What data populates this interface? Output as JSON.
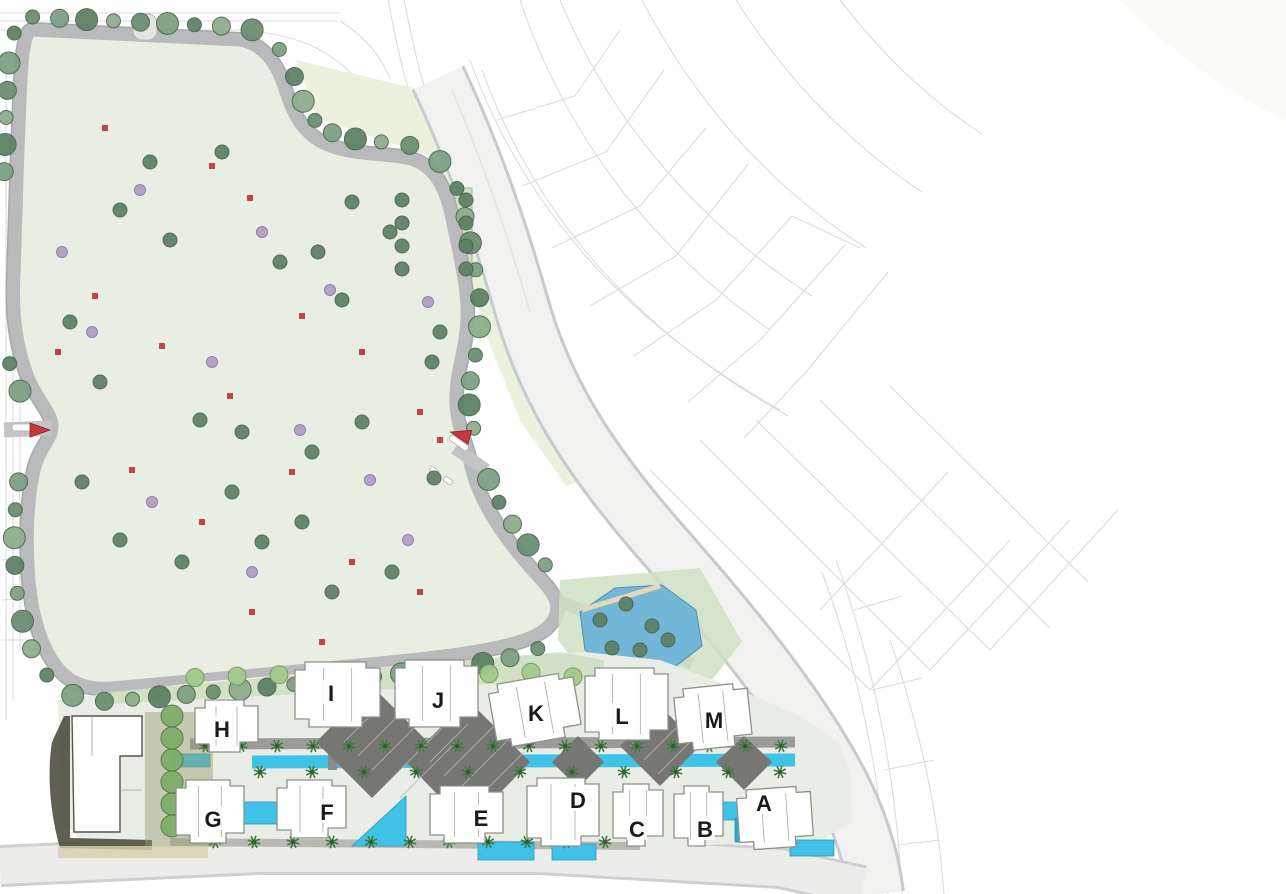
{
  "map": {
    "kind": "residential master plan site map",
    "buildings": [
      {
        "label": "H",
        "x": 222,
        "y": 729
      },
      {
        "label": "I",
        "x": 331,
        "y": 693
      },
      {
        "label": "J",
        "x": 438,
        "y": 700
      },
      {
        "label": "K",
        "x": 536,
        "y": 713
      },
      {
        "label": "L",
        "x": 622,
        "y": 716
      },
      {
        "label": "M",
        "x": 714,
        "y": 720
      },
      {
        "label": "G",
        "x": 213,
        "y": 819
      },
      {
        "label": "F",
        "x": 327,
        "y": 812
      },
      {
        "label": "E",
        "x": 481,
        "y": 818
      },
      {
        "label": "D",
        "x": 578,
        "y": 800
      },
      {
        "label": "C",
        "x": 637,
        "y": 829
      },
      {
        "label": "B",
        "x": 705,
        "y": 829
      },
      {
        "label": "A",
        "x": 764,
        "y": 803
      }
    ],
    "rows": {
      "upper_row_labels": [
        "H",
        "I",
        "J",
        "K",
        "L",
        "M"
      ],
      "lower_row_labels": [
        "G",
        "F",
        "E",
        "D",
        "C",
        "B",
        "A"
      ]
    },
    "entrance_markers": [
      {
        "name": "west-entrance-marker",
        "x": 30,
        "y": 423,
        "angle": 0
      },
      {
        "name": "main-entrance-marker",
        "x": 468,
        "y": 444,
        "angle": 195
      }
    ],
    "palette": {
      "road": "#b2b4b5",
      "context_line": "#d2d6d8",
      "parcel_ground": "#e8eee2",
      "lawn": "#cfe0c4",
      "water": "#79b9d8",
      "water_light": "#a6d4e6",
      "canal": "#3fc2e8",
      "building_fill": "#ffffff",
      "terrace_edge": "#bed3b8",
      "tree_dark": "#5d7f63",
      "tree_light": "#a4c98c",
      "tree_lilac": "#b3a0c6",
      "accent_red": "#c4383f",
      "deck_dark": "#767672",
      "shadow_olive": "#4e4f3e"
    }
  }
}
